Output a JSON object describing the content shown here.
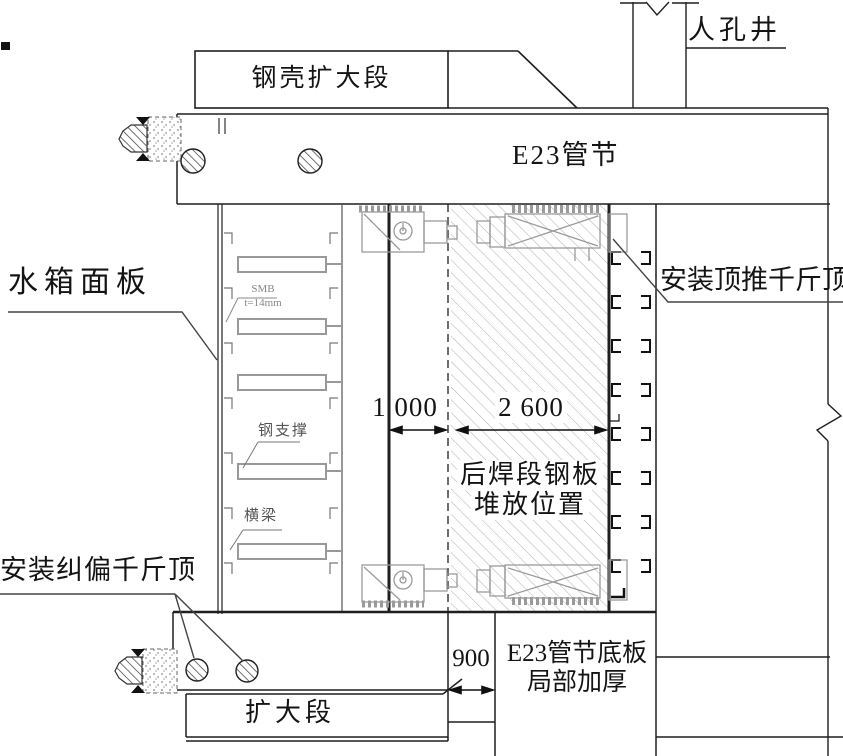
{
  "drawing": {
    "labels": {
      "manhole": "人孔井",
      "steel_shell_enlarged": "钢壳扩大段",
      "e23_segment": "E23管节",
      "water_tank_panel": "水箱面板",
      "plate_spec_line1": "SMB",
      "plate_spec_line2": "t=14mm",
      "steel_support": "钢支撑",
      "cross_beam": "横梁",
      "push_jack": "安装顶推千斤顶",
      "correction_jack": "安装纠偏千斤顶",
      "stacking_line1": "后焊段钢板",
      "stacking_line2": "堆放位置",
      "bottom_plate_line1": "E23管节底板",
      "bottom_plate_line2": "局部加厚",
      "enlarged_section": "扩大段"
    },
    "dimensions": {
      "stacking_offset": "1 000",
      "stacking_width": "2 600",
      "bottom_thicken_width": "900"
    },
    "colors": {
      "line": "#1f1f1f",
      "light_detail": "#9a9a9a",
      "hatch": "#b5b5b5"
    }
  }
}
